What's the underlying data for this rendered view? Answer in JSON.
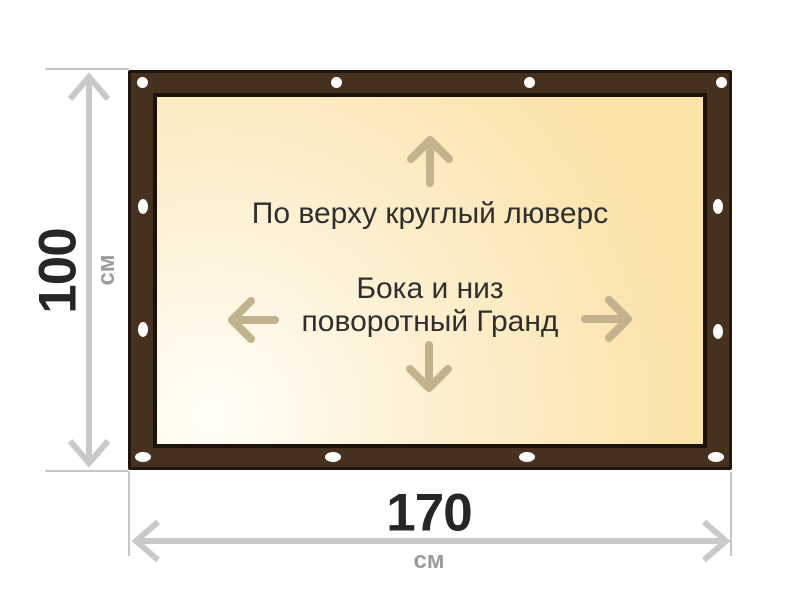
{
  "diagram": {
    "height_dimension": {
      "value": "100",
      "unit": "см"
    },
    "width_dimension": {
      "value": "170",
      "unit": "см"
    },
    "panel_text": {
      "top_note": "По верху круглый люверс",
      "middle_note_line1": "Бока и низ",
      "middle_note_line2": "поворотный Гранд"
    },
    "grommet_count": 12,
    "colors": {
      "frame_brown": "#46301e",
      "frame_outline": "#20160e",
      "panel_gradient_light": "#fffef8",
      "panel_gradient_dark": "#fae2a8",
      "grommet_white": "#ffffff",
      "dimension_gray": "#c9c9c9",
      "unit_gray": "#9b9b9b",
      "number_dark": "#262626",
      "text_dark": "#2f2f2f",
      "panel_arrow_tan": "#c2b28d"
    }
  }
}
